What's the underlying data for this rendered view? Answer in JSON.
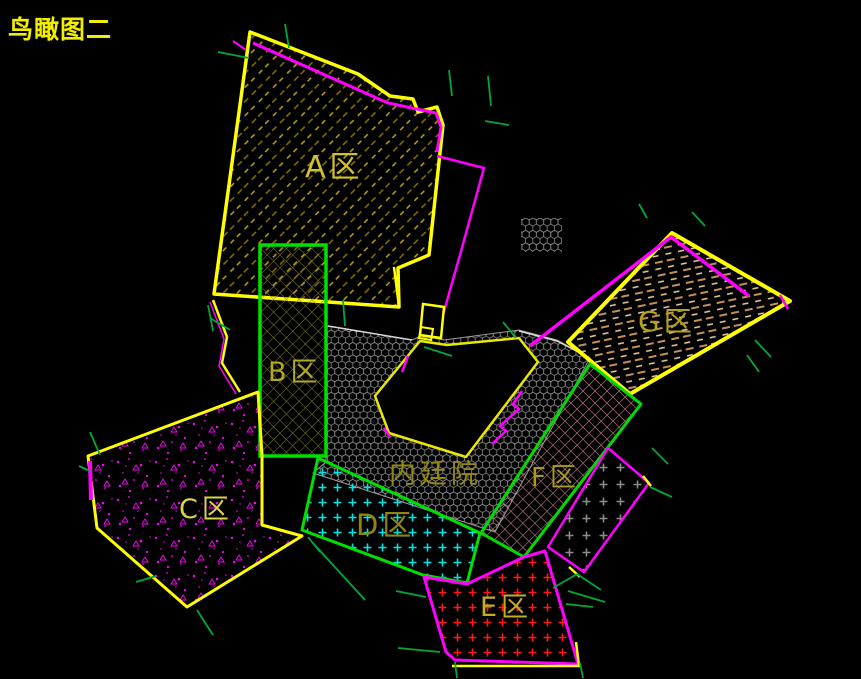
{
  "page_title": "鸟瞰图二",
  "drawing": {
    "background": "#000000",
    "zones": [
      {
        "key": "a",
        "label": "A区",
        "outline_color": "#ffff00",
        "label_color": "#cfc130",
        "hatch": "olive-diagonal-dash"
      },
      {
        "key": "b",
        "label": "B区",
        "outline_color": "#00e000",
        "label_color": "#b3a822",
        "hatch": "olive-crosshatch"
      },
      {
        "key": "c",
        "label": "C区",
        "outline_color": "#ffff00",
        "label_color": "#d8d545",
        "hatch": "magenta-speckle"
      },
      {
        "key": "d",
        "label": "D区",
        "outline_color": "#00e000",
        "label_color": "#8f850e",
        "hatch": "cyan-plus-grid"
      },
      {
        "key": "e",
        "label": "E区",
        "outline_color": "#ff00ff",
        "label_color": "#bfae24",
        "hatch": "red-plus-grid"
      },
      {
        "key": "f",
        "label": "F区",
        "outline_color": "#00dc00",
        "label_color": "#aa9a1a",
        "hatch": "pink-crosshatch"
      },
      {
        "key": "g",
        "label": "G区",
        "outline_color": "#ffff00",
        "label_color": "#b2a217",
        "hatch": "tan-dash"
      },
      {
        "key": "courtyard",
        "label": "内廷院",
        "outline_color": "#9a9a9a",
        "label_color": "#938910",
        "hatch": "gray-hex-mesh"
      },
      {
        "key": "annex",
        "label": "",
        "outline_color": "#ff00ff",
        "label_color": "#909090",
        "hatch": "gray-plus-grid"
      }
    ],
    "palette": {
      "outline_yellow": "#ffff00",
      "outline_green": "#00e000",
      "outline_magenta": "#ff00ff",
      "boundary_white": "#d8d8d8",
      "tick_green": "#00a838",
      "hex_gray": "#989898",
      "hatch_olive_dark": "#8a7200",
      "hatch_olive_light": "#c2a21a",
      "hatch_pink": "#d28888",
      "hatch_tan": "#c4905a",
      "hatch_cream": "#ecd2a6",
      "plus_cyan": "#00e5e5",
      "plus_red": "#ff1a1a",
      "plus_gray": "#8c8c8c",
      "title_color": "#f2ee00"
    }
  }
}
